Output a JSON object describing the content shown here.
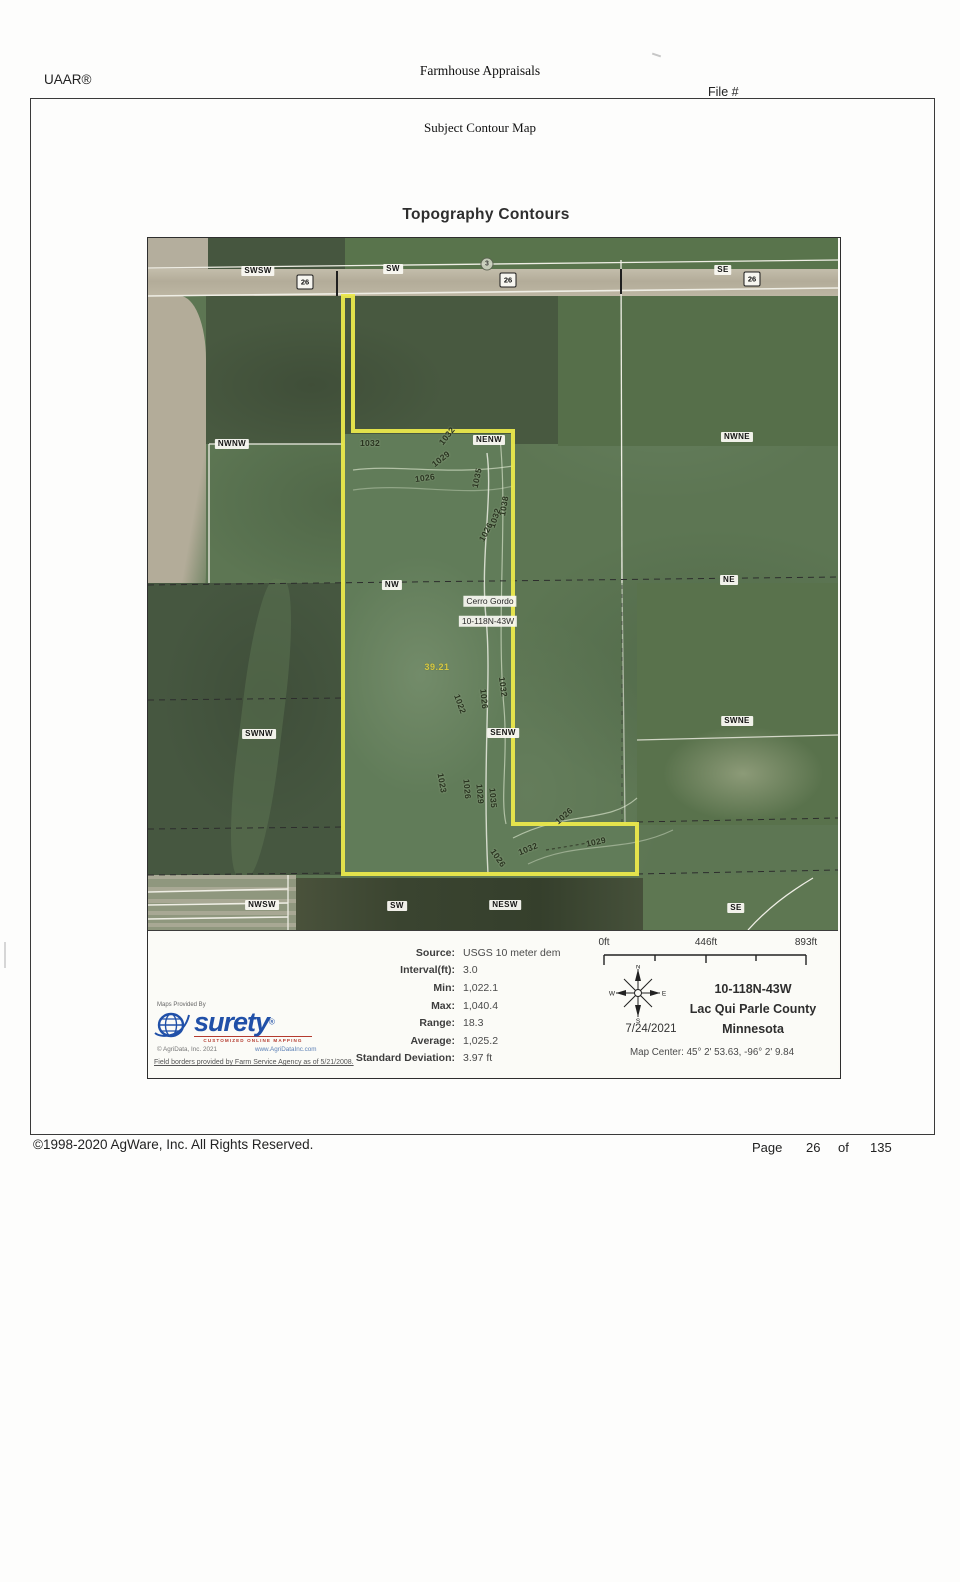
{
  "header": {
    "brand": "UAAR®",
    "company": "Farmhouse Appraisals",
    "file_label": "File #"
  },
  "page": {
    "section_title": "Subject Contour Map",
    "map_heading": "Topography Contours"
  },
  "map": {
    "aliquot_labels": [
      {
        "t": "SWSW",
        "x": 110,
        "y": 33
      },
      {
        "t": "SW",
        "x": 245,
        "y": 31
      },
      {
        "t": "SE",
        "x": 575,
        "y": 32
      },
      {
        "t": "NWNW",
        "x": 84,
        "y": 206
      },
      {
        "t": "NENW",
        "x": 341,
        "y": 202
      },
      {
        "t": "NWNE",
        "x": 589,
        "y": 199
      },
      {
        "t": "NW",
        "x": 244,
        "y": 347
      },
      {
        "t": "NE",
        "x": 581,
        "y": 342
      },
      {
        "t": "SWNW",
        "x": 111,
        "y": 496
      },
      {
        "t": "SENW",
        "x": 355,
        "y": 495
      },
      {
        "t": "SWNE",
        "x": 589,
        "y": 483
      },
      {
        "t": "NWSW",
        "x": 114,
        "y": 667
      },
      {
        "t": "SW",
        "x": 249,
        "y": 668
      },
      {
        "t": "NESW",
        "x": 357,
        "y": 667
      },
      {
        "t": "SE",
        "x": 588,
        "y": 670
      }
    ],
    "highway_shields": [
      {
        "t": "26",
        "x": 157,
        "y": 44
      },
      {
        "t": "26",
        "x": 360,
        "y": 42
      },
      {
        "t": "26",
        "x": 604,
        "y": 41
      }
    ],
    "route_dot": {
      "t": "3",
      "x": 339,
      "y": 26
    },
    "place_labels": [
      {
        "t": "Cerro Gordo",
        "x": 342,
        "y": 363
      },
      {
        "t": "10-118N-43W",
        "x": 340,
        "y": 383
      }
    ],
    "area_label": {
      "t": "39.21",
      "x": 289,
      "y": 429
    },
    "contour_labels": [
      {
        "t": "1032",
        "x": 222,
        "y": 205,
        "r": 0
      },
      {
        "t": "1032",
        "x": 299,
        "y": 198,
        "r": -52
      },
      {
        "t": "1029",
        "x": 293,
        "y": 221,
        "r": -38
      },
      {
        "t": "1026",
        "x": 277,
        "y": 240,
        "r": -8
      },
      {
        "t": "1035",
        "x": 329,
        "y": 240,
        "r": -78
      },
      {
        "t": "1038",
        "x": 356,
        "y": 268,
        "r": -80
      },
      {
        "t": "1032",
        "x": 347,
        "y": 280,
        "r": -72
      },
      {
        "t": "1026",
        "x": 338,
        "y": 294,
        "r": -62
      },
      {
        "t": "1032",
        "x": 355,
        "y": 449,
        "r": 82
      },
      {
        "t": "1026",
        "x": 336,
        "y": 461,
        "r": 84
      },
      {
        "t": "1022",
        "x": 312,
        "y": 466,
        "r": 70
      },
      {
        "t": "1023",
        "x": 294,
        "y": 545,
        "r": 80
      },
      {
        "t": "1026",
        "x": 319,
        "y": 551,
        "r": 85
      },
      {
        "t": "1029",
        "x": 332,
        "y": 556,
        "r": 85
      },
      {
        "t": "1035",
        "x": 345,
        "y": 560,
        "r": 85
      },
      {
        "t": "1026",
        "x": 416,
        "y": 578,
        "r": -42
      },
      {
        "t": "1032",
        "x": 380,
        "y": 611,
        "r": -22
      },
      {
        "t": "1029",
        "x": 448,
        "y": 604,
        "r": -12
      },
      {
        "t": "1026",
        "x": 350,
        "y": 620,
        "r": 55
      }
    ]
  },
  "legend": {
    "stats": [
      {
        "label": "Source:",
        "value": "USGS 10 meter dem"
      },
      {
        "label": "Interval(ft):",
        "value": "3.0"
      },
      {
        "label": "Min:",
        "value": "1,022.1"
      },
      {
        "label": "Max:",
        "value": "1,040.4"
      },
      {
        "label": "Range:",
        "value": "18.3"
      },
      {
        "label": "Average:",
        "value": "1,025.2"
      },
      {
        "label": "Standard Deviation:",
        "value": "3.97 ft"
      }
    ],
    "scale_ticks": [
      "0ft",
      "446ft",
      "893ft"
    ],
    "compass": {
      "n": "N",
      "e": "E",
      "s": "S",
      "w": "W"
    },
    "date": "7/24/2021",
    "location": [
      "10-118N-43W",
      "Lac Qui Parle County",
      "Minnesota"
    ],
    "map_center": "Map Center: 45° 2' 53.63,  -96° 2' 9.84",
    "provider": {
      "maps_provided_by": "Maps Provided By",
      "name": "surety",
      "reg": "®",
      "tagline": "CUSTOMIZED ONLINE MAPPING",
      "copyright": "© AgriData, Inc. 2021",
      "website": "www.AgriDataInc.com",
      "field_borders": "Field borders provided by Farm Service Agency as of 5/21/2008."
    }
  },
  "footer": {
    "copyright": "©1998-2020 AgWare, Inc. All Rights Reserved.",
    "page_label": "Page",
    "page_number": "26",
    "of_label": "of",
    "page_total": "135"
  },
  "colors": {
    "parcel_outline": "#ecea3f",
    "surety_blue": "#2050a8",
    "tagline_red": "#b43a2e",
    "area_label_yellow": "#d9ca35"
  }
}
